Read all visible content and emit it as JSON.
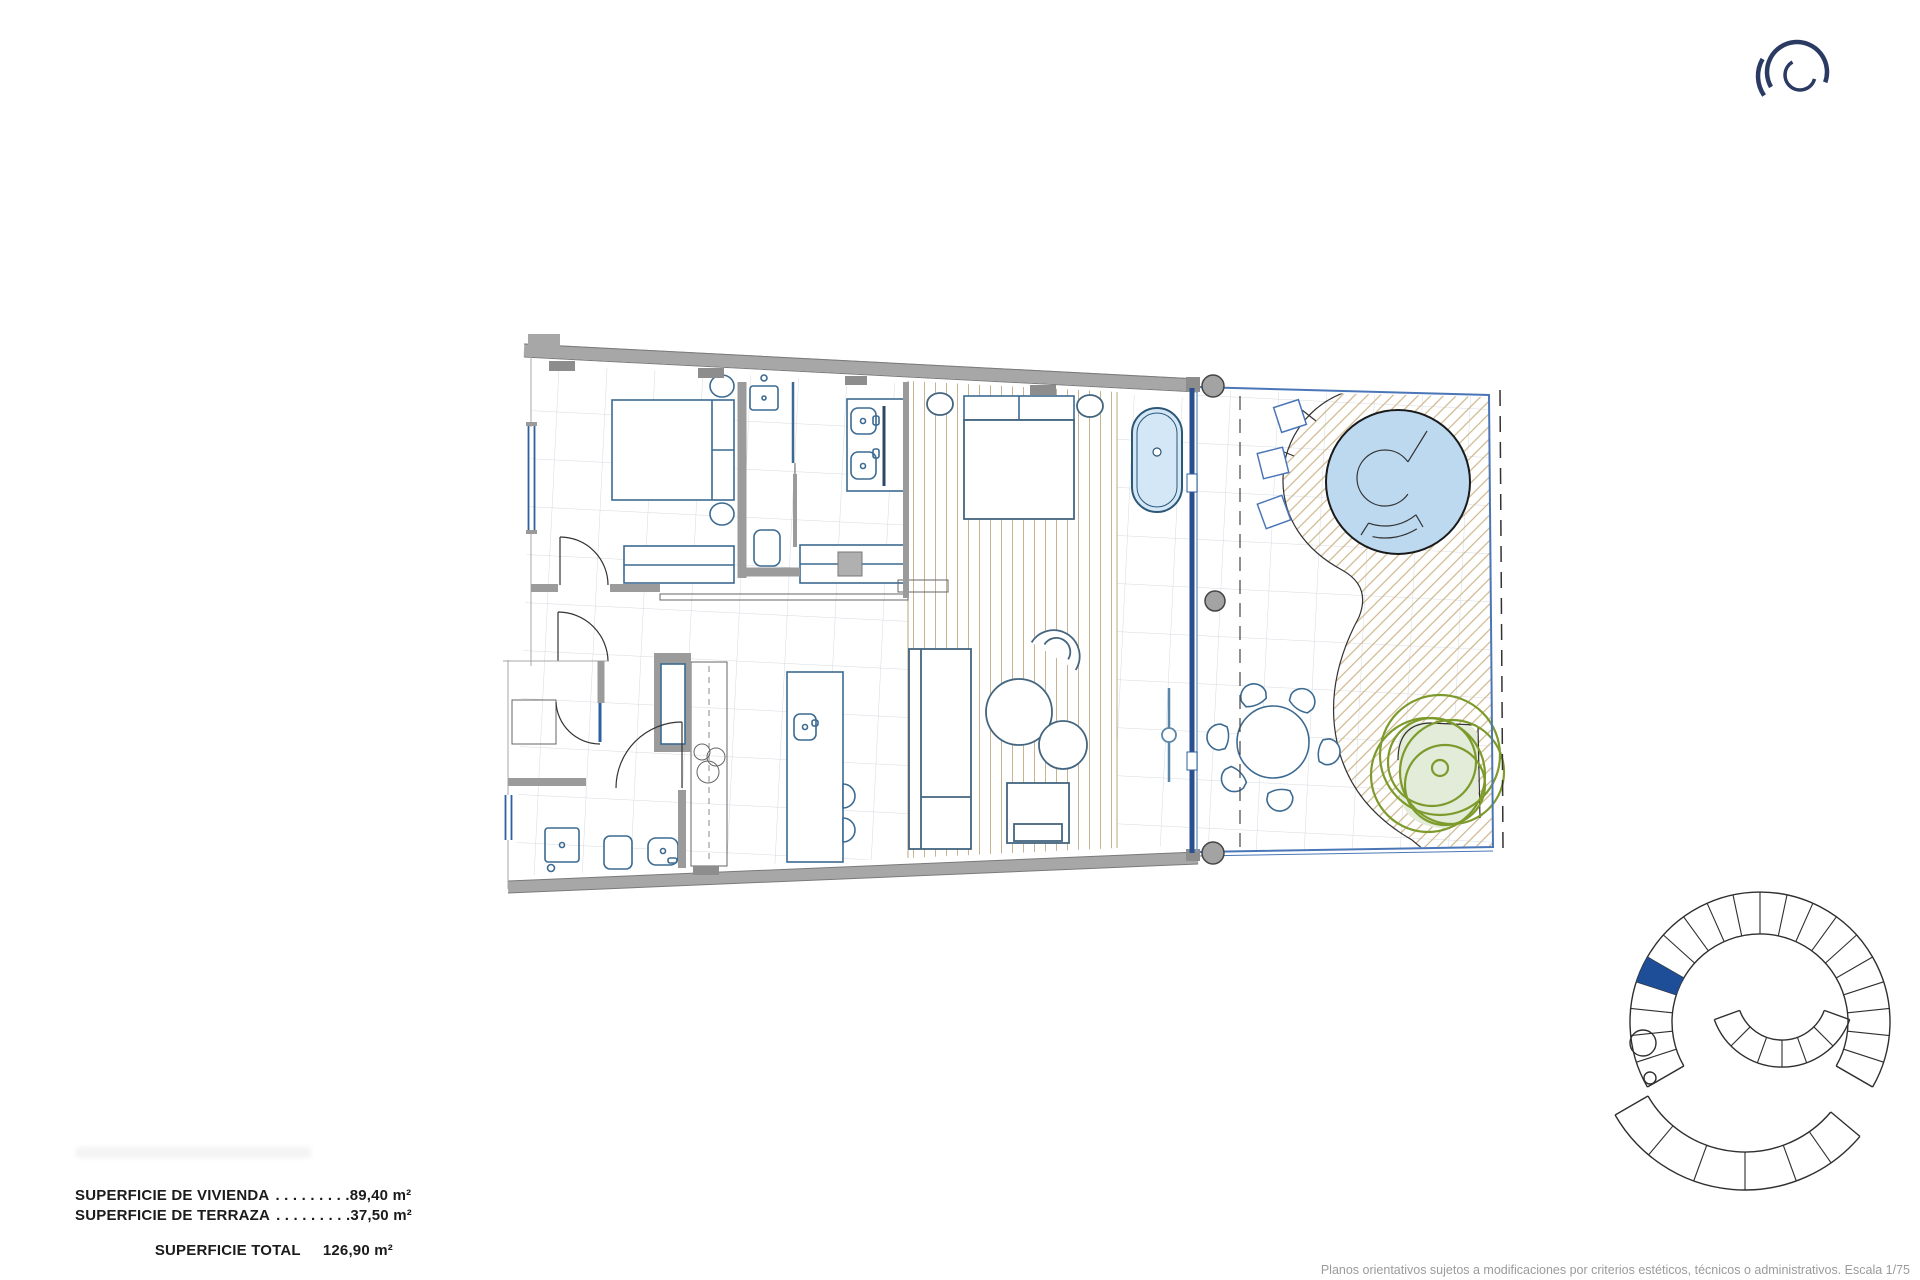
{
  "sheet": {
    "background": "#ffffff"
  },
  "surface_table": {
    "rows": [
      {
        "label": "SUPERFICIE DE VIVIENDA",
        "dots": ". . . . . . . . .",
        "value": "89,40 m²"
      },
      {
        "label": "SUPERFICIE DE TERRAZA",
        "dots": ". . . . . . . . .",
        "value": "37,50 m²"
      }
    ],
    "total_label": "SUPERFICIE TOTAL",
    "total_value": "126,90 m²"
  },
  "footer": {
    "disclaimer": "Planos orientativos sujetos a modificaciones por criterios estéticos, técnicos o administrativos. Escala 1/75"
  },
  "brand": {
    "logo_icon": "concentric-ring-logo",
    "color": "#2a3a62"
  },
  "site_plan": {
    "icon": "building-key-plan",
    "highlight_color": "#1e4e97",
    "line_color": "#2f2f2f"
  },
  "floor_plan": {
    "colors": {
      "wall": "#a7a7a7",
      "wall_dark": "#8d8d8d",
      "glass": "#2a4f8f",
      "window": "#2e5f9e",
      "fixture": "#3c6a91",
      "furniture": "#44657f",
      "pool_water": "#bcd9f0",
      "tub_water": "#d3e7f7",
      "wood_stripe": "#c9b28f",
      "deck_hatch": "#cdb68c",
      "tile_grid": "#d6dae1",
      "tree": "#7d9b2c",
      "tree_bed": "#e2ecd8",
      "column": "#a3a3a3",
      "terrace_edge": "#4a76b8"
    }
  }
}
